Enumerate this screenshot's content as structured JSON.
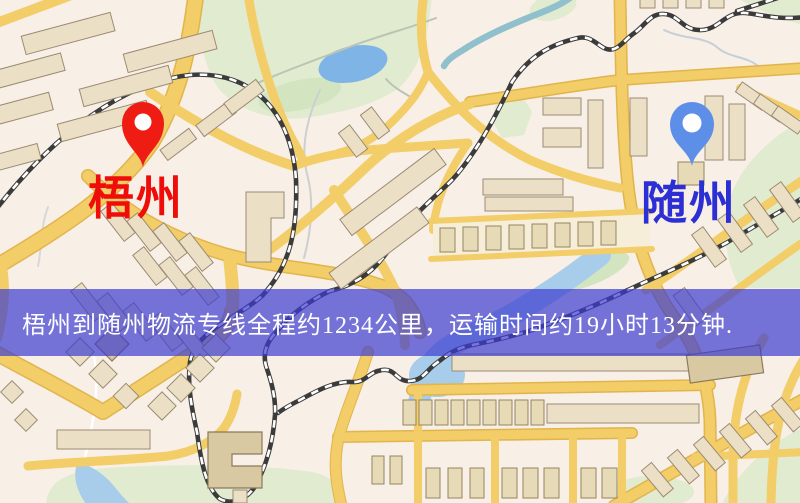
{
  "map": {
    "description_note": "stylized city street map",
    "origin": {
      "name": "梧州",
      "pin_color": "#ee1c13",
      "label_color": "#ef0d0a"
    },
    "destination": {
      "name": "随州",
      "pin_color": "#5d8fe9",
      "label_color": "#2b2fd4"
    },
    "colors": {
      "background": "#f8efe7",
      "road": "#f2cd68",
      "road_casing": "#e2b44c",
      "building_fill": "#ebe0c5",
      "building_stroke": "#9c8b73",
      "park": "#e0ebd0",
      "water": "#a8cdea",
      "railway": "#3b3b3b",
      "railway_dash": "#ffffff"
    }
  },
  "banner": {
    "text": "梧州到随州物流专线全程约1234公里，运输时间约19小时13分钟.",
    "background_color": "rgba(60,60,208,0.70)",
    "text_color": "#ffffff"
  },
  "route": {
    "origin": "梧州",
    "destination": "随州",
    "distance_text": "约1234公里",
    "duration_text": "约19小时13分钟"
  }
}
